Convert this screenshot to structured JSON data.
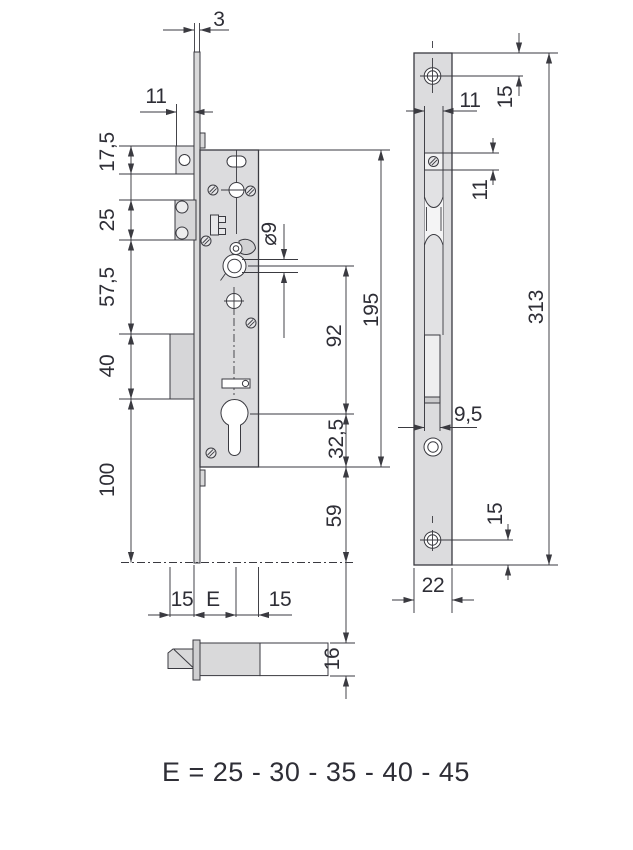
{
  "side_view": {
    "plate_thickness": "3",
    "front_offset": "11",
    "left_chain": [
      "17,5",
      "25",
      "57,5",
      "40",
      "100"
    ],
    "follower_hole": "⌀9",
    "follower_to_cylinder": "92",
    "case_height": "195",
    "cylinder_to_case_end": "32,5",
    "case_to_plate_end": "59",
    "bottom_dims": [
      "15",
      "E",
      "15"
    ],
    "latch_height": "16"
  },
  "front_view": {
    "top_hole_offset": "15",
    "slot_width": "11",
    "screw_slot_height": "11",
    "plate_length": "313",
    "bolt_slot_width": "9,5",
    "bottom_hole_offset": "15",
    "plate_width": "22"
  },
  "footer": {
    "formula": "E = 25 - 30 - 35 - 40 - 45"
  }
}
